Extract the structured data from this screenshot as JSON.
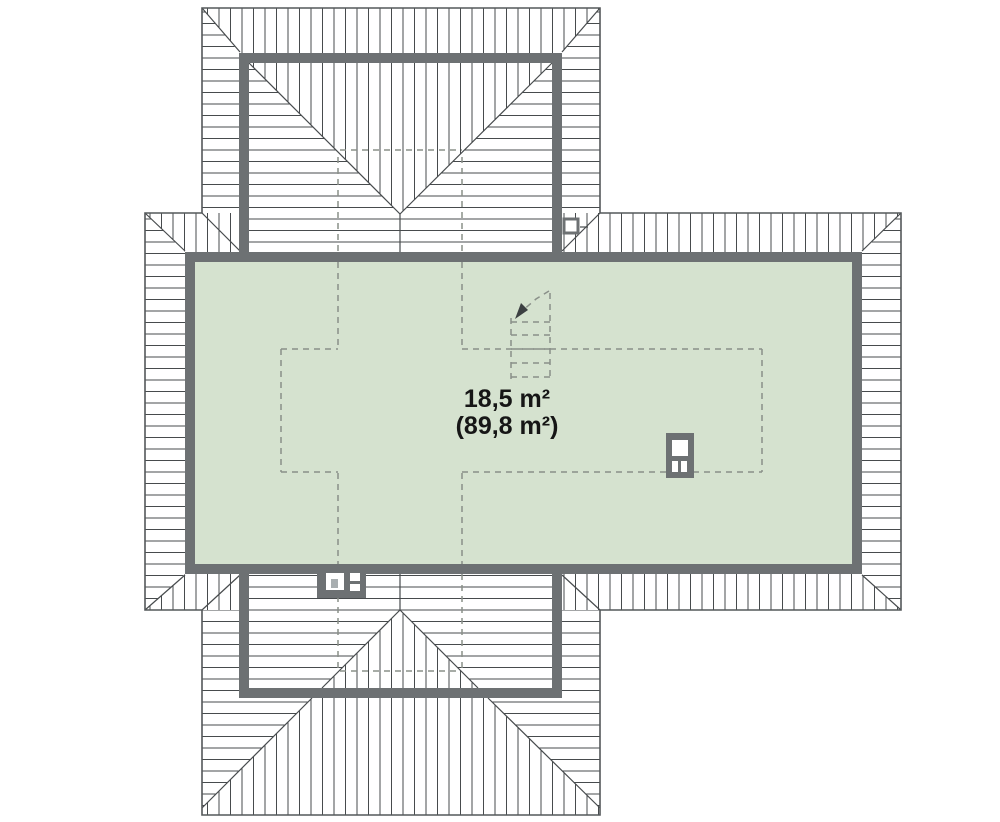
{
  "plan": {
    "type": "attic-roof-floor-plan",
    "labels": {
      "area_usable": "18,5 m²",
      "area_total": "(89,8 m²)"
    },
    "symbols": [
      {
        "name": "chimney-large",
        "location": "right-of-room"
      },
      {
        "name": "chimney-small",
        "location": "bottom-wall"
      },
      {
        "name": "roof-window",
        "location": "top-right-valley"
      }
    ],
    "rooms": [
      {
        "name": "attic-room",
        "usable_area": "18,5 m²",
        "floor_area": "(89,8 m²)"
      }
    ]
  },
  "colors": {
    "background_color": "#ffffff",
    "hatch_color": "#474b4d",
    "outline_color": "#54585a",
    "wall_color": "#6d7173",
    "floor_fill": "#d5e2cf",
    "dashed_color": "#8a9089",
    "text_color": "#161616",
    "symbol_light": "#ffffff"
  }
}
